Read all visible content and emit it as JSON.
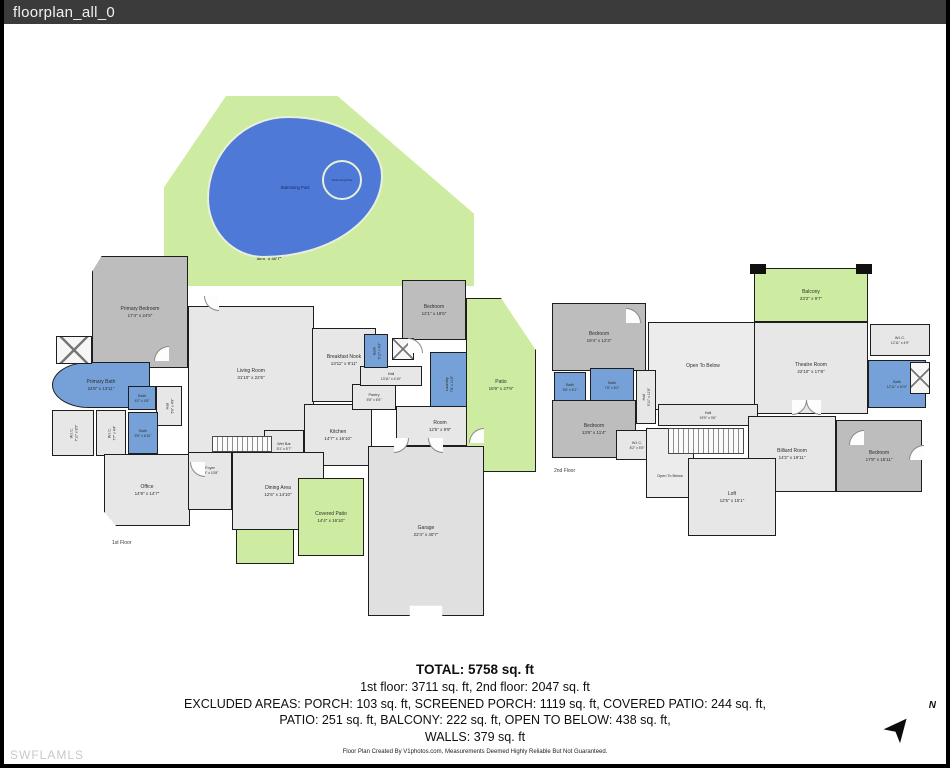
{
  "header": {
    "title": "floorplan_all_0"
  },
  "watermark": "SWFLAMLS",
  "compass": {
    "label": "N"
  },
  "colors": {
    "wall": "#1e1e1e",
    "bedroom_fill": "#bdbdbd",
    "floor_fill": "#e7e7e7",
    "bath_fill": "#76a1d8",
    "outdoor_fill": "#cdeca1",
    "pool_fill": "#4e79d6",
    "titlebar": "#3b3b3b"
  },
  "floor1": {
    "label": "1st Floor",
    "rooms": {
      "swimming_pool": {
        "name": "Swimming Pool",
        "dims": ""
      },
      "spa": {
        "name": "Swimming Pool",
        "dims": ""
      },
      "screened_porch": {
        "name": "Screened Porch",
        "dims": "48'6\" x 40'7\""
      },
      "primary_bedroom": {
        "name": "Primary Bedroom",
        "dims": "17'4\" x 24'5\""
      },
      "primary_bath": {
        "name": "Primary Bath",
        "dims": "24'6\" x 13'11\""
      },
      "bath_a": {
        "name": "Bath",
        "dims": "6'2\" x 4'8\""
      },
      "bath_b": {
        "name": "Bath",
        "dims": "5'9\" x 6'10\""
      },
      "wic_a": {
        "name": "W.I.C.",
        "dims": "7'10\" x 8'5\""
      },
      "wic_b": {
        "name": "W.I.C.",
        "dims": "7'7\" x 4'4\""
      },
      "hall_a": {
        "name": "Hall",
        "dims": "5'6\" x 4'9\""
      },
      "living_room": {
        "name": "Living Room",
        "dims": "31'10\" x 22'6\""
      },
      "breakfast_nook": {
        "name": "Breakfast Nook",
        "dims": "13'11\" x 9'11\""
      },
      "wet_bar": {
        "name": "Wet Bar",
        "dims": "5'1\" x 5'7\""
      },
      "kitchen": {
        "name": "Kitchen",
        "dims": "14'7\" x 16'10\""
      },
      "pantry": {
        "name": "Pantry",
        "dims": "5'5\" x 6'5\""
      },
      "hall_b": {
        "name": "Hall",
        "dims": "13'11\" x 4'10\""
      },
      "bath_c": {
        "name": "Bath",
        "dims": "5'10\" x 4'6\""
      },
      "laundry": {
        "name": "Laundry",
        "dims": "7'8\" x 11'8\""
      },
      "bedroom": {
        "name": "Bedroom",
        "dims": "12'1\" x 18'5\""
      },
      "patio": {
        "name": "Patio",
        "dims": "16'9\" x 27'9\""
      },
      "room": {
        "name": "Room",
        "dims": "12'5\" x 9'9\""
      },
      "foyer": {
        "name": "Foyer",
        "dims": "8'5\" x 10'8\""
      },
      "office": {
        "name": "Office",
        "dims": "14'9\" x 14'7\""
      },
      "dining_area": {
        "name": "Dining Area",
        "dims": "12'6\" x 14'10\""
      },
      "porch": {
        "name": "Porch",
        "dims": "7'7\" x 13'8\""
      },
      "covered_patio": {
        "name": "Covered Patio",
        "dims": "14'4\" x 16'10\""
      },
      "garage": {
        "name": "Garage",
        "dims": "22'4\" x 40'7\""
      }
    }
  },
  "floor2": {
    "label": "2nd Floor",
    "rooms": {
      "balcony": {
        "name": "Balcony",
        "dims": "23'2\" x 9'7\""
      },
      "bedroom_a": {
        "name": "Bedroom",
        "dims": "19'4\" x 12'3\""
      },
      "open_below_a": {
        "name": "Open To Below",
        "dims": ""
      },
      "theatre_room": {
        "name": "Theatre Room",
        "dims": "22'10\" x 17'8\""
      },
      "wic_a": {
        "name": "W.I.C.",
        "dims": "12'11\" x 4'9\""
      },
      "bath_a": {
        "name": "Bath",
        "dims": "12'11\" x 10'9\""
      },
      "bath_b": {
        "name": "Bath",
        "dims": "5'6\" x 5'1\""
      },
      "bath_c": {
        "name": "Bath",
        "dims": "7'6\" x 5'2\""
      },
      "hall_a": {
        "name": "Hall",
        "dims": "5'10\" x 11'8\""
      },
      "bedroom_b": {
        "name": "Bedroom",
        "dims": "13'6\" x 11'4\""
      },
      "wic_b": {
        "name": "W.I.C.",
        "dims": "8'2\" x 5'5\""
      },
      "hall_b": {
        "name": "Hall",
        "dims": "19'9\" x 3'6\""
      },
      "open_below_b": {
        "name": "Open To Below",
        "dims": ""
      },
      "billiard_room": {
        "name": "Billiard Room",
        "dims": "14'2\" x 19'11\""
      },
      "loft": {
        "name": "Loft",
        "dims": "12'5\" x 15'1\""
      },
      "bedroom_c": {
        "name": "Bedroom",
        "dims": "17'8\" x 15'11\""
      }
    }
  },
  "summary": {
    "total": "TOTAL: 5758 sq. ft",
    "floors": "1st floor: 3711 sq. ft, 2nd floor: 2047 sq. ft",
    "excluded1": "EXCLUDED AREAS: PORCH: 103 sq. ft, SCREENED PORCH: 1119 sq. ft, COVERED PATIO: 244 sq. ft,",
    "excluded2": "PATIO: 251 sq. ft, BALCONY: 222 sq. ft, OPEN TO BELOW: 438 sq. ft,",
    "excluded3": "WALLS: 379 sq. ft",
    "credit": "Floor Plan Created By V1photos.com, Measurements Deemed Highly Reliable But Not Guaranteed."
  }
}
